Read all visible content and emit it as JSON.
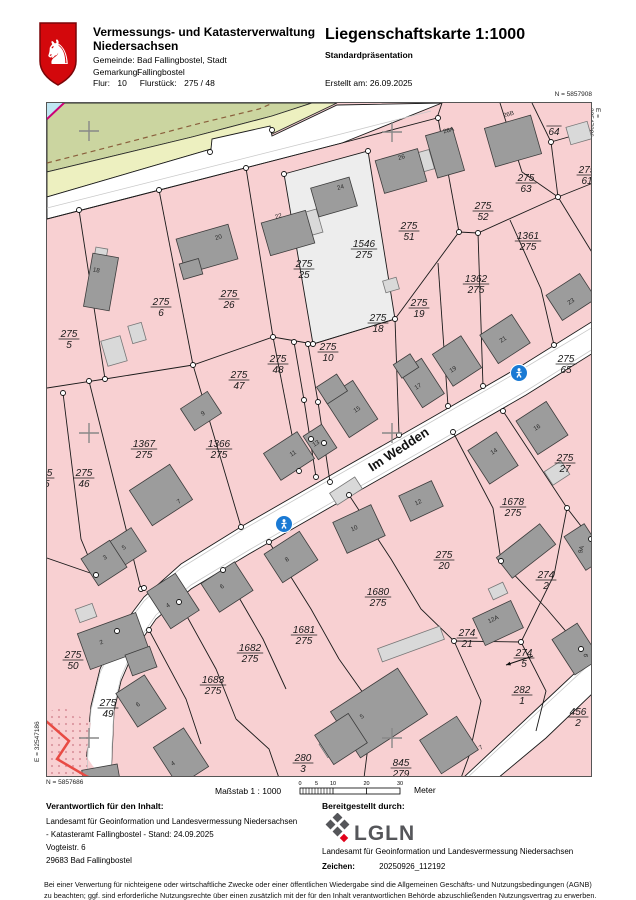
{
  "header": {
    "agency_line1": "Vermessungs- und Katasterverwaltung",
    "agency_line2": "Niedersachsen",
    "gemeinde_label": "Gemeinde:",
    "gemeinde": "Bad Fallingbostel, Stadt",
    "gemarkung_label": "Gemarkung:",
    "gemarkung": "Fallingbostel",
    "flur_label": "Flur:",
    "flur": "10",
    "flurstueck_label": "Flurstück:",
    "flurstueck": "275 / 48",
    "title": "Liegenschaftskarte 1:1000",
    "subtitle": "Standardpräsentation",
    "created": "Erstellt am: 26.09.2025"
  },
  "corners": {
    "n_top": "N = 5857908",
    "e_right": "E = 32547306",
    "n_bottom": "N = 5857686",
    "e_left": "E = 32547186"
  },
  "scalebar": {
    "masstab": "Maßstab 1 : 1000",
    "ticks": [
      "0",
      "5",
      "10",
      "20",
      "30"
    ],
    "unit": "Meter"
  },
  "footer": {
    "left_head": "Verantwortlich für den Inhalt:",
    "left_lines": [
      "Landesamt für Geoinformation und Landesvermessung Niedersachsen",
      "- Katasteramt Fallingbostel -   Stand: 24.09.2025",
      "Vogteistr. 6",
      "29683 Bad Fallingbostel"
    ],
    "right_head": "Bereitgestellt durch:",
    "logo_text": "LGLN",
    "right_line": "Landesamt für Geoinformation und Landesvermessung Niedersachsen",
    "zeichen_label": "Zeichen:",
    "zeichen_value": "20250926_112192"
  },
  "disclaimer": [
    "Bei einer Verwertung für nichteigene oder wirtschaftliche Zwecke oder einer öffentlichen Wiedergabe sind die Allgemeinen Geschäfts- und Nutzungsbedingungen (AGNB)",
    "zu beachten; ggf. sind erforderliche Nutzungsrechte über einen zusätzlich mit der für den Inhalt verantwortlichen Behörde abzuschließenden Nutzungsvertrag zu erwerben."
  ],
  "map": {
    "street_label": {
      "text": "Im Wedden",
      "x": 400,
      "y": 452,
      "rot": -33
    },
    "colors": {
      "parcel_pink": "#f8d0d2",
      "green": "#cbd5a0",
      "yellow": "#edf0c0",
      "road": "#ffffff",
      "white_parcel": "#ededed",
      "bld_dark": "#9c9c9c",
      "bld_dark_stroke": "#3c3c3c",
      "bld_light": "#d9d9d9",
      "bld_light_stroke": "#777777",
      "boundary": "#1a1a1a",
      "red_line": "#e84b44",
      "cyan": "#bfe6f2",
      "magenta": "#cc0077",
      "sign_blue": "#1a7ad4",
      "dash_brown": "#8a5f3c",
      "cross_gray": "#888888",
      "dot_pink": "#dc97a0"
    },
    "regions": [
      {
        "pts": "46,102 311,102 271,115 191,136 46,171",
        "fill": "green",
        "stroke": "#2a2a2a"
      },
      {
        "pts": "46,171 191,136 271,115 311,102 336,102 271,133 210,148 46,196",
        "fill": "yellow",
        "stroke": "#2a2a2a"
      },
      {
        "pts": "46,196 210,148 211,138 269,125 271,135 336,104 441,102 341,142 46,218",
        "fill": "road",
        "stroke": "#1a1a1a"
      },
      {
        "pts": "283,173 367,150 394,318 312,343",
        "fill": "white_parcel",
        "stroke": "#1a1a1a"
      },
      {
        "pts": "592,320 520,365 430,417 330,474 243,524 180,563 143,596 116,632 99,668 90,705 86,745 85,777 110,777 113,710 120,680 133,650 155,618 190,588 248,553 335,503 435,446 525,394 592,352",
        "fill": "road",
        "stroke": "#1a1a1a"
      },
      {
        "pts": "592,655 525,718 462,777 497,777 545,737 592,692",
        "fill": "road",
        "stroke": "#1a1a1a"
      },
      {
        "pts": "46,715 56,722 50,755 46,758",
        "fill": "yellow",
        "stroke": "#2a2a2a"
      },
      {
        "pts": "46,712 60,705 90,722 85,755 100,777 46,777",
        "fill": "parcel_pink",
        "stroke": "none",
        "dots": true
      },
      {
        "pts": "46,102 63,102 46,118",
        "fill": "cyan",
        "stroke": "none"
      }
    ],
    "gray_lines": [
      "46,207 340,133 430,110",
      "592,326 520,369 430,421 330,478 243,528 180,567 143,600 116,636 99,672 90,709 87,749 86,777",
      "592,348 525,390 435,442 335,499 248,549 190,584 155,614 133,646 120,676 113,706 111,746 110,777",
      "592,660 525,722 466,777"
    ],
    "dash_line": "46,162 120,143 200,122 258,108 272,102",
    "magenta_line": "63,102 46,118",
    "red_line": "45,720 68,740 56,758 85,775 90,777",
    "lines": [
      "46,218 341,142 436,117 441,102",
      "78,209 104,378",
      "158,189 192,364",
      "245,167 272,336",
      "437,117 458,231",
      "499,102 521,171 557,196",
      "531,102 550,141",
      "550,141 592,129",
      "550,141 557,196",
      "557,196 592,182",
      "46,387 104,378 192,364 272,336 312,343 394,318 458,231 477,232 557,196",
      "88,380 140,588",
      "192,364 240,526",
      "272,336 298,470",
      "293,341 303,399 315,476",
      "307,343 317,401 329,481",
      "394,318 398,434",
      "437,262 447,405",
      "477,232 482,385",
      "509,219 540,288 553,344",
      "557,196 592,253",
      "502,410 566,507 590,538",
      "452,431 492,507 500,560",
      "500,560 545,607 580,648",
      "348,494 390,558 420,608 453,640",
      "268,541 310,608 338,658",
      "222,569 262,638 285,688",
      "178,601 215,668 235,718",
      "148,629 185,698 200,743",
      "453,640 520,641",
      "520,641 553,574 566,507",
      "520,641 545,690 535,730",
      "453,640 480,700 468,755 460,777",
      "338,658 372,706 363,777",
      "235,718 268,748 278,777",
      "46,557 95,574",
      "62,392 80,538 95,574"
    ],
    "buildings_dark": [
      [
        100,
        281,
        26,
        54,
        10
      ],
      [
        206,
        248,
        54,
        36,
        -16
      ],
      [
        190,
        268,
        20,
        16,
        -16
      ],
      [
        287,
        232,
        46,
        34,
        -16
      ],
      [
        333,
        196,
        40,
        30,
        -16
      ],
      [
        400,
        170,
        44,
        34,
        -16
      ],
      [
        444,
        152,
        28,
        44,
        -16
      ],
      [
        512,
        140,
        48,
        40,
        -16
      ],
      [
        200,
        410,
        32,
        26,
        -33
      ],
      [
        288,
        455,
        40,
        32,
        -33
      ],
      [
        319,
        441,
        22,
        28,
        -33
      ],
      [
        350,
        408,
        34,
        46,
        -33
      ],
      [
        331,
        388,
        24,
        20,
        -33
      ],
      [
        421,
        382,
        26,
        42,
        -33
      ],
      [
        405,
        365,
        20,
        16,
        -33
      ],
      [
        456,
        360,
        34,
        38,
        -33
      ],
      [
        504,
        338,
        38,
        34,
        -33
      ],
      [
        570,
        296,
        40,
        30,
        -33
      ],
      [
        492,
        457,
        34,
        40,
        -33
      ],
      [
        541,
        427,
        36,
        40,
        -33
      ],
      [
        160,
        494,
        48,
        42,
        -33
      ],
      [
        126,
        546,
        28,
        28,
        -33
      ],
      [
        103,
        562,
        34,
        32,
        -33
      ],
      [
        112,
        640,
        62,
        38,
        -20
      ],
      [
        140,
        660,
        26,
        22,
        -20
      ],
      [
        172,
        600,
        34,
        44,
        -33
      ],
      [
        226,
        586,
        40,
        34,
        -33
      ],
      [
        290,
        556,
        42,
        34,
        -33
      ],
      [
        358,
        528,
        42,
        34,
        -25
      ],
      [
        420,
        500,
        36,
        28,
        -25
      ],
      [
        497,
        622,
        42,
        30,
        -25
      ],
      [
        584,
        546,
        24,
        40,
        -33
      ],
      [
        525,
        550,
        55,
        26,
        -38
      ],
      [
        140,
        700,
        34,
        40,
        -33
      ],
      [
        180,
        756,
        36,
        46,
        -33
      ],
      [
        378,
        712,
        80,
        55,
        -33
      ],
      [
        448,
        744,
        44,
        40,
        -33
      ],
      [
        575,
        648,
        30,
        42,
        -33
      ],
      [
        340,
        738,
        40,
        35,
        -33
      ],
      [
        100,
        775,
        36,
        18,
        -10
      ]
    ],
    "buildings_light": [
      [
        578,
        132,
        22,
        18,
        -16
      ],
      [
        113,
        350,
        20,
        26,
        -16
      ],
      [
        136,
        332,
        14,
        18,
        -16
      ],
      [
        345,
        490,
        30,
        14,
        -33
      ],
      [
        410,
        643,
        66,
        14,
        -20
      ],
      [
        556,
        472,
        20,
        16,
        -33
      ],
      [
        497,
        590,
        16,
        12,
        -25
      ],
      [
        424,
        160,
        14,
        20,
        -16
      ],
      [
        310,
        222,
        18,
        24,
        -16
      ],
      [
        85,
        612,
        18,
        14,
        -20
      ],
      [
        330,
        745,
        18,
        16,
        -33
      ],
      [
        390,
        284,
        14,
        12,
        -16
      ],
      [
        100,
        252,
        12,
        10,
        10
      ]
    ],
    "parcel_labels": [
      {
        "n": "275",
        "d": "5",
        "x": 68,
        "y": 336
      },
      {
        "n": "275",
        "d": "6",
        "x": 160,
        "y": 304
      },
      {
        "n": "275",
        "d": "26",
        "x": 228,
        "y": 296
      },
      {
        "n": "275",
        "d": "25",
        "x": 303,
        "y": 266
      },
      {
        "n": "1546",
        "d": "275",
        "x": 363,
        "y": 246
      },
      {
        "n": "275",
        "d": "51",
        "x": 408,
        "y": 228
      },
      {
        "n": "275",
        "d": "52",
        "x": 482,
        "y": 208
      },
      {
        "n": "275",
        "d": "63",
        "x": 525,
        "y": 180
      },
      {
        "n": "",
        "d": "64",
        "x": 553,
        "y": 126
      },
      {
        "n": "275",
        "d": "61",
        "x": 586,
        "y": 172
      },
      {
        "n": "1361",
        "d": "275",
        "x": 527,
        "y": 238
      },
      {
        "n": "1362",
        "d": "275",
        "x": 475,
        "y": 281
      },
      {
        "n": "275",
        "d": "19",
        "x": 418,
        "y": 305
      },
      {
        "n": "275",
        "d": "18",
        "x": 377,
        "y": 320
      },
      {
        "n": "275",
        "d": "10",
        "x": 327,
        "y": 349
      },
      {
        "n": "275",
        "d": "48",
        "x": 277,
        "y": 361
      },
      {
        "n": "275",
        "d": "47",
        "x": 238,
        "y": 377
      },
      {
        "n": "1367",
        "d": "275",
        "x": 143,
        "y": 446
      },
      {
        "n": "1366",
        "d": "275",
        "x": 218,
        "y": 446
      },
      {
        "n": "275",
        "d": "46",
        "x": 83,
        "y": 475
      },
      {
        "n": "275",
        "d": "45",
        "x": 43,
        "y": 475
      },
      {
        "n": "275",
        "d": "65",
        "x": 565,
        "y": 361
      },
      {
        "n": "275",
        "d": "27",
        "x": 564,
        "y": 460
      },
      {
        "n": "1678",
        "d": "275",
        "x": 512,
        "y": 504
      },
      {
        "n": "275",
        "d": "20",
        "x": 443,
        "y": 557
      },
      {
        "n": "1680",
        "d": "275",
        "x": 377,
        "y": 594
      },
      {
        "n": "274",
        "d": "2",
        "x": 545,
        "y": 577
      },
      {
        "n": "274",
        "d": "21",
        "x": 466,
        "y": 635
      },
      {
        "n": "274",
        "d": "5",
        "x": 523,
        "y": 655
      },
      {
        "n": "282",
        "d": "1",
        "x": 521,
        "y": 692
      },
      {
        "n": "456",
        "d": "2",
        "x": 577,
        "y": 714
      },
      {
        "n": "1681",
        "d": "275",
        "x": 303,
        "y": 632
      },
      {
        "n": "1682",
        "d": "275",
        "x": 249,
        "y": 650
      },
      {
        "n": "1683",
        "d": "275",
        "x": 212,
        "y": 682
      },
      {
        "n": "275",
        "d": "50",
        "x": 72,
        "y": 657
      },
      {
        "n": "275",
        "d": "49",
        "x": 107,
        "y": 705
      },
      {
        "n": "280",
        "d": "3",
        "x": 302,
        "y": 760
      },
      {
        "n": "845",
        "d": "279",
        "x": 400,
        "y": 765
      }
    ],
    "house_numbers": [
      {
        "t": "18",
        "x": 95,
        "y": 271,
        "r": 10
      },
      {
        "t": "20",
        "x": 218,
        "y": 238,
        "r": -16
      },
      {
        "t": "22",
        "x": 278,
        "y": 217,
        "r": -16
      },
      {
        "t": "24",
        "x": 340,
        "y": 188,
        "r": -16
      },
      {
        "t": "26",
        "x": 401,
        "y": 158,
        "r": -16
      },
      {
        "t": "26A",
        "x": 448,
        "y": 131,
        "r": -16
      },
      {
        "t": "26B",
        "x": 508,
        "y": 115,
        "r": -16
      },
      {
        "t": "9",
        "x": 203,
        "y": 414,
        "r": -33
      },
      {
        "t": "11",
        "x": 293,
        "y": 454,
        "r": -33
      },
      {
        "t": "13",
        "x": 316,
        "y": 444,
        "r": -33
      },
      {
        "t": "15",
        "x": 357,
        "y": 410,
        "r": -33
      },
      {
        "t": "17",
        "x": 418,
        "y": 387,
        "r": -33
      },
      {
        "t": "19",
        "x": 453,
        "y": 370,
        "r": -33
      },
      {
        "t": "21",
        "x": 503,
        "y": 340,
        "r": -33
      },
      {
        "t": "23",
        "x": 571,
        "y": 302,
        "r": -33
      },
      {
        "t": "14",
        "x": 494,
        "y": 452,
        "r": -33
      },
      {
        "t": "16",
        "x": 537,
        "y": 428,
        "r": -33
      },
      {
        "t": "7",
        "x": 179,
        "y": 502,
        "r": -33
      },
      {
        "t": "5",
        "x": 124,
        "y": 548,
        "r": -33
      },
      {
        "t": "3",
        "x": 105,
        "y": 558,
        "r": -33
      },
      {
        "t": "2",
        "x": 101,
        "y": 643,
        "r": -20
      },
      {
        "t": "4",
        "x": 168,
        "y": 606,
        "r": -33
      },
      {
        "t": "6",
        "x": 222,
        "y": 587,
        "r": -33
      },
      {
        "t": "8",
        "x": 287,
        "y": 560,
        "r": -33
      },
      {
        "t": "10",
        "x": 354,
        "y": 529,
        "r": -25
      },
      {
        "t": "12",
        "x": 418,
        "y": 503,
        "r": -25
      },
      {
        "t": "12A",
        "x": 493,
        "y": 620,
        "r": -25
      },
      {
        "t": "9A",
        "x": 582,
        "y": 549,
        "r": -75
      },
      {
        "t": "6",
        "x": 138,
        "y": 705,
        "r": -33
      },
      {
        "t": "4",
        "x": 173,
        "y": 764,
        "r": -33
      },
      {
        "t": "5",
        "x": 362,
        "y": 717,
        "r": -33
      },
      {
        "t": "7",
        "x": 481,
        "y": 748,
        "r": -33
      },
      {
        "t": "9",
        "x": 587,
        "y": 655,
        "r": -75
      }
    ],
    "dots": [
      [
        78,
        209
      ],
      [
        158,
        189
      ],
      [
        245,
        167
      ],
      [
        283,
        173
      ],
      [
        367,
        150
      ],
      [
        437,
        117
      ],
      [
        209,
        151
      ],
      [
        271,
        129
      ],
      [
        104,
        378
      ],
      [
        192,
        364
      ],
      [
        272,
        336
      ],
      [
        312,
        343
      ],
      [
        394,
        318
      ],
      [
        458,
        231
      ],
      [
        477,
        232
      ],
      [
        557,
        196
      ],
      [
        550,
        141
      ],
      [
        293,
        341
      ],
      [
        307,
        343
      ],
      [
        303,
        399
      ],
      [
        317,
        401
      ],
      [
        310,
        438
      ],
      [
        323,
        442
      ],
      [
        240,
        526
      ],
      [
        298,
        470
      ],
      [
        315,
        476
      ],
      [
        329,
        481
      ],
      [
        398,
        434
      ],
      [
        447,
        405
      ],
      [
        482,
        385
      ],
      [
        553,
        344
      ],
      [
        502,
        410
      ],
      [
        452,
        431
      ],
      [
        348,
        494
      ],
      [
        268,
        541
      ],
      [
        222,
        569
      ],
      [
        178,
        601
      ],
      [
        148,
        629
      ],
      [
        453,
        640
      ],
      [
        520,
        641
      ],
      [
        566,
        507
      ],
      [
        590,
        538
      ],
      [
        500,
        560
      ],
      [
        580,
        648
      ],
      [
        95,
        574
      ],
      [
        140,
        588
      ],
      [
        88,
        380
      ],
      [
        62,
        392
      ],
      [
        143,
        587
      ],
      [
        116,
        630
      ]
    ],
    "crosses": [
      [
        88,
        130
      ],
      [
        391,
        131
      ],
      [
        88,
        432
      ],
      [
        391,
        432
      ],
      [
        88,
        737
      ],
      [
        391,
        737
      ]
    ],
    "signs": [
      {
        "x": 518,
        "y": 372
      },
      {
        "x": 283,
        "y": 523
      }
    ],
    "arrow": {
      "x1": 532,
      "y1": 655,
      "x2": 505,
      "y2": 664
    }
  }
}
